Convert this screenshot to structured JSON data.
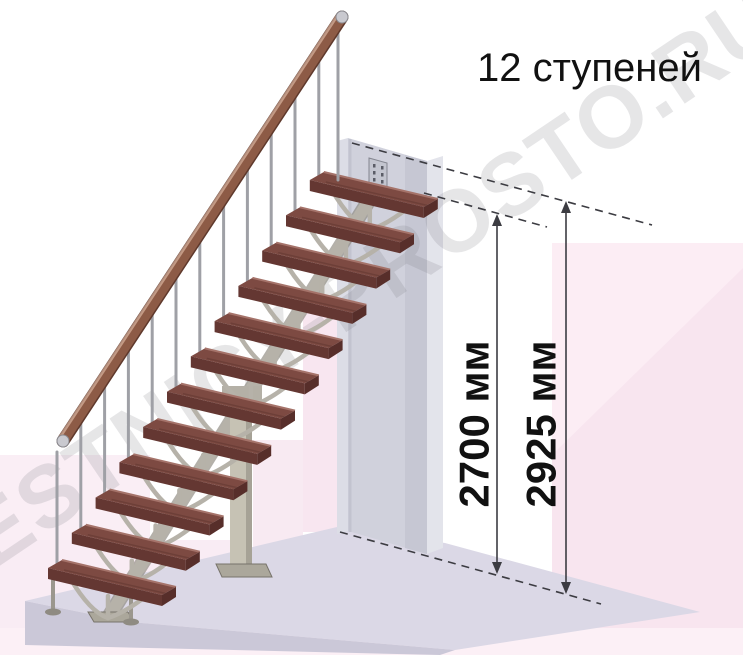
{
  "title": "12 ступеней",
  "watermark": "LESTNICY-PROSTO.RU",
  "stair": {
    "steps_count": 12,
    "handrail": true
  },
  "dimensions": {
    "floor_to_top_step": {
      "label": "2700 мм",
      "value": 2700,
      "unit": "мм"
    },
    "floor_to_floor": {
      "label": "2925 мм",
      "value": 2925,
      "unit": "мм"
    }
  },
  "colors": {
    "tread_top": "#7d4a42",
    "tread_front": "#643732",
    "tread_end": "#572e2a",
    "tread_highlight": "#a5736a",
    "metal": "#b6b2a9",
    "baluster": "#9fa0a6",
    "handrail_wood": "#8d5b46",
    "wall": "#d0d1dc",
    "floor_top": "#dbd8e6",
    "floor_front": "#cbc8d8",
    "background_pink": "#f8e5ef",
    "dimension_line": "#3c3c42",
    "text": "#111111",
    "watermark_gray": "#77777f"
  }
}
